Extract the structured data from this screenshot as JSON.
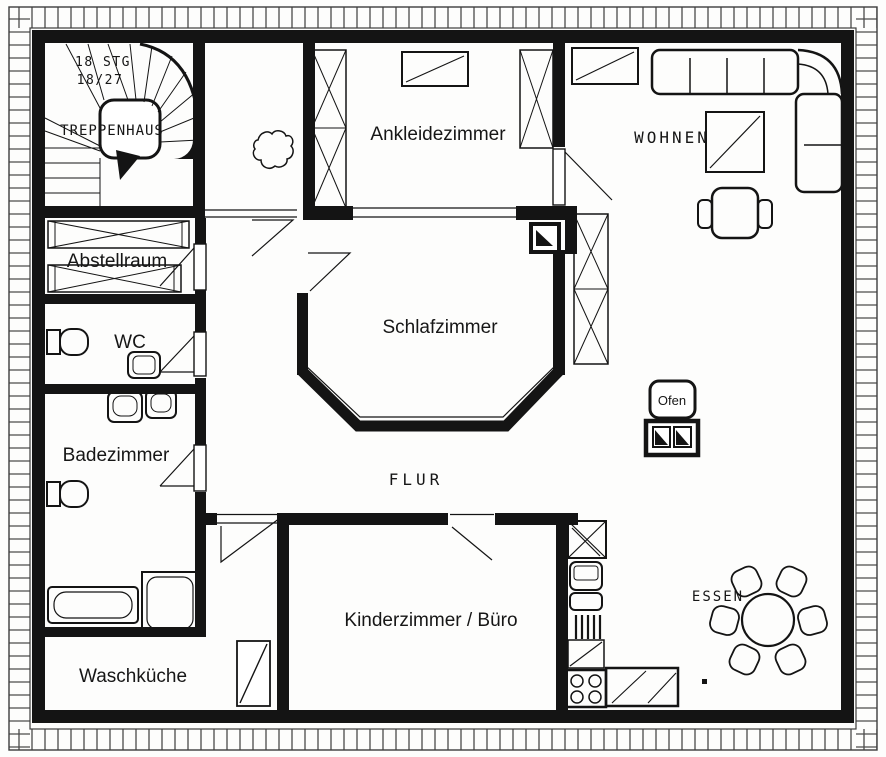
{
  "floorplan": {
    "rooms": [
      {
        "id": "treppenhaus",
        "label": "TREPPENHAUS"
      },
      {
        "id": "ankleidezimmer",
        "label": "Ankleidezimmer"
      },
      {
        "id": "wohnen",
        "label": "WOHNEN"
      },
      {
        "id": "abstellraum",
        "label": "Abstellraum"
      },
      {
        "id": "wc",
        "label": "WC"
      },
      {
        "id": "schlafzimmer",
        "label": "Schlafzimmer"
      },
      {
        "id": "badezimmer",
        "label": "Badezimmer"
      },
      {
        "id": "flur",
        "label": "FLUR"
      },
      {
        "id": "kinderzimmer",
        "label": "Kinderzimmer / Büro"
      },
      {
        "id": "essen",
        "label": "ESSEN"
      },
      {
        "id": "waschkueche",
        "label": "Waschküche"
      }
    ],
    "stair_note": {
      "line1": "18 STG",
      "line2": "18/27"
    },
    "oven_label": "Ofen"
  },
  "colors": {
    "ink": "#141414",
    "paper": "#ffffff"
  }
}
